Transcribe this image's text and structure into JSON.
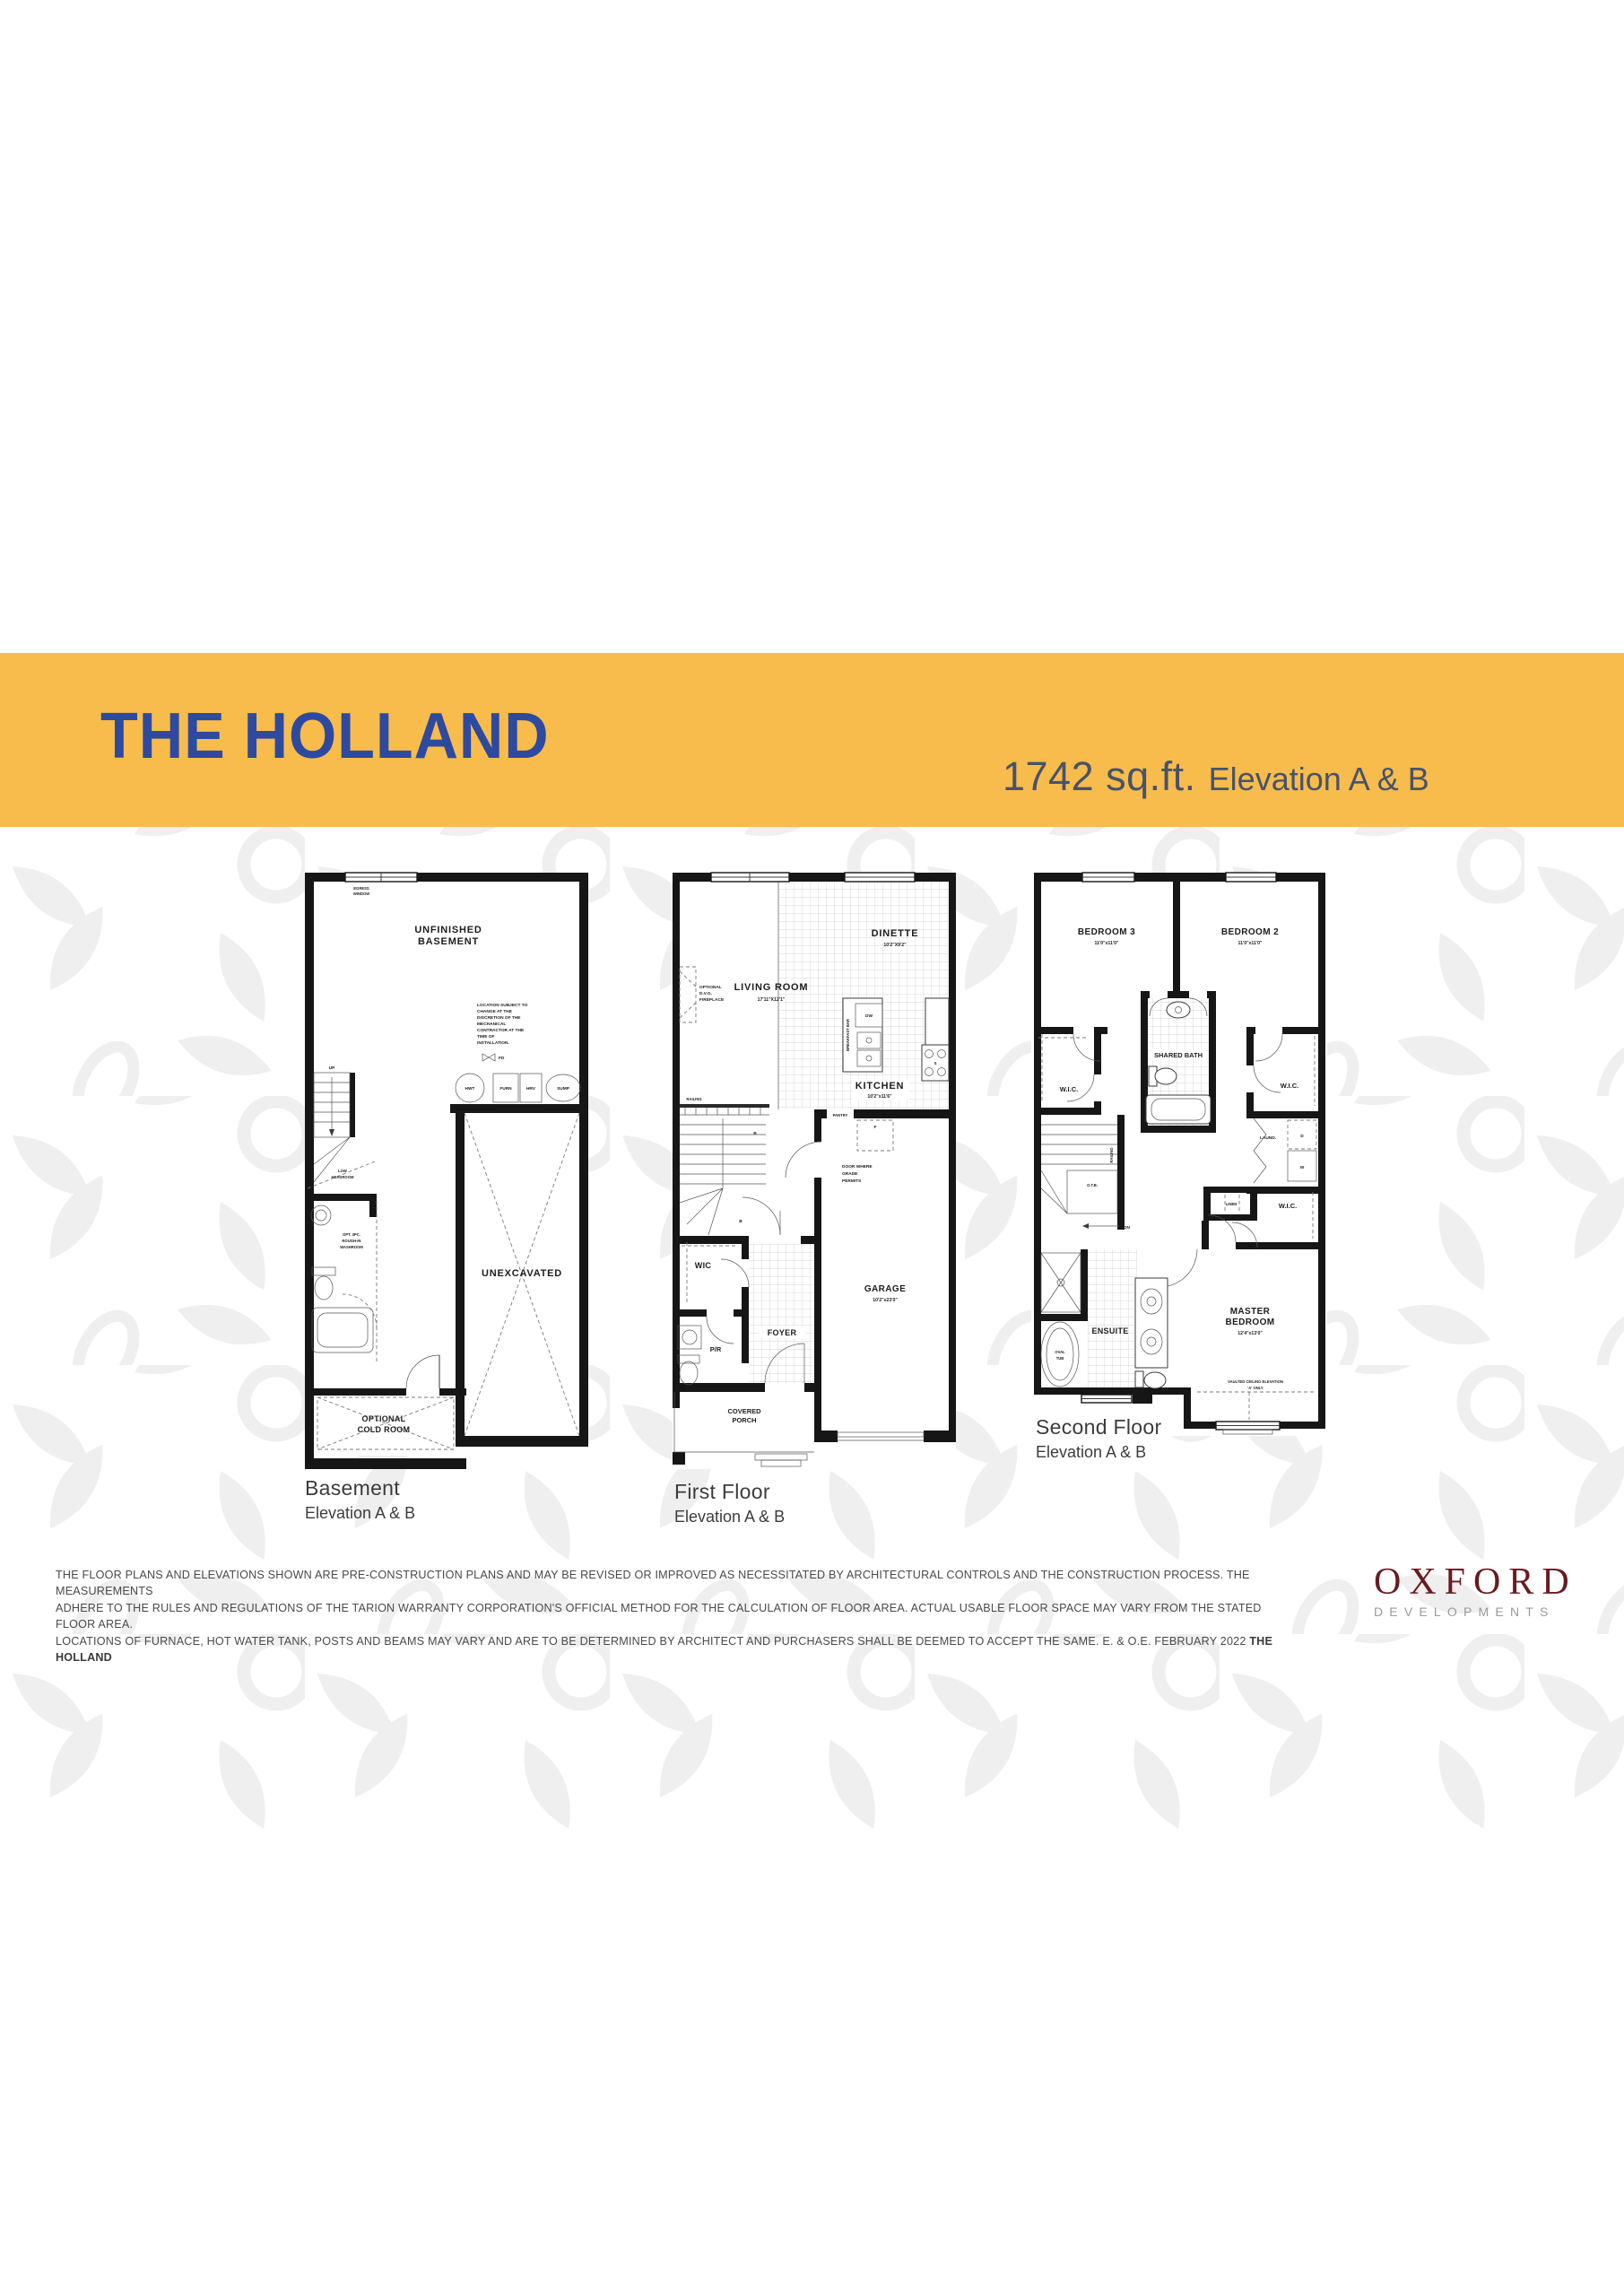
{
  "header": {
    "title": "THE HOLLAND",
    "sqft": "1742 sq.ft.",
    "elevation": "Elevation A & B"
  },
  "colors": {
    "band": "#F8BC4C",
    "title_blue": "#2E4AA0",
    "subtitle_slate": "#47536B",
    "wall_black": "#161616",
    "leaf_gray": "#EFEFEF",
    "caption_gray": "#3C3C3C",
    "disclaimer_gray": "#4A4A4A",
    "oxford_maroon": "#691A20",
    "developments_gray": "#9B9B9B"
  },
  "plans": {
    "basement": {
      "caption": "Basement",
      "caption_sub": "Elevation A & B",
      "egress_1": "EGRESS",
      "egress_2": "WINDOW",
      "room_1": "UNFINISHED",
      "room_2": "BASEMENT",
      "note": [
        "LOCATION SUBJECT TO",
        "CHANGE AT THE",
        "DISCRETION OF THE",
        "MECHANICAL",
        "CONTRACTOR AT THE",
        "TIME OF",
        "INSTALLATION."
      ],
      "fd": "FD",
      "up": "UP",
      "hwt": "HWT",
      "furn": "FURN",
      "hrv": "HRV",
      "sump": "SUMP",
      "low_1": "LOW",
      "low_2": "HEADROOM",
      "washroom": [
        "OPT. 3PC.",
        "ROUGH-IN",
        "WASHROOM"
      ],
      "unexcavated": "UNEXCAVATED",
      "cold_1": "OPTIONAL",
      "cold_2": "COLD ROOM"
    },
    "first": {
      "caption": "First Floor",
      "caption_sub": "Elevation A & B",
      "dinette": "DINETTE",
      "dinette_dims": "10'2\"X9'2\"",
      "living": "LIVING ROOM",
      "living_dims": "17'11\"X12'1\"",
      "fireplace": [
        "OPTIONAL",
        "D.V.G.",
        "FIREPLACE"
      ],
      "breakfast_bar": "BREAKFAST BAR",
      "dw": "DW",
      "kitchen": "KITCHEN",
      "kitchen_dims": "10'2\"x11'6\"",
      "pantry": "PANTRY",
      "fridge": "F",
      "stove": "S",
      "railing": "RAILING",
      "stair_b": "B",
      "door_note": [
        "DOOR WHERE",
        "GRADE",
        "PERMITS"
      ],
      "wic": "WIC",
      "pr": "P/R",
      "foyer": "FOYER",
      "porch_1": "COVERED",
      "porch_2": "PORCH",
      "garage": "GARAGE",
      "garage_dims": "10'2\"x23'0\""
    },
    "second": {
      "caption": "Second Floor",
      "caption_sub": "Elevation A & B",
      "bedroom3": "BEDROOM 3",
      "bedroom3_dims": "11'0\"x11'0\"",
      "bedroom2": "BEDROOM 2",
      "bedroom2_dims": "11'0\"x11'0\"",
      "shared_bath": "SHARED BATH",
      "wic_left": "W.I.C.",
      "wic_right": "W.I.C.",
      "wic_master": "W.I.C.",
      "laundry": "LAUND.",
      "dryer": "D",
      "washer": "W",
      "otb": "O.T.B.",
      "railing": "RAILING",
      "dn": "DN",
      "linen": "LINEN",
      "ensuite": "ENSUITE",
      "oval_1": "OVAL",
      "oval_2": "TUB",
      "master_1": "MASTER",
      "master_2": "BEDROOM",
      "master_dims": "12'4\"x13'0\"",
      "vaulted_1": "VAULTED CEILING ELEVATION",
      "vaulted_2": "'A' ONLY"
    }
  },
  "footer": {
    "disclaimer_1": "THE FLOOR PLANS AND ELEVATIONS SHOWN ARE PRE-CONSTRUCTION PLANS AND MAY BE REVISED OR IMPROVED AS NECESSITATED BY ARCHITECTURAL CONTROLS AND THE CONSTRUCTION PROCESS. THE MEASUREMENTS",
    "disclaimer_2": "ADHERE TO THE RULES AND REGULATIONS OF THE TARION WARRANTY CORPORATION'S OFFICIAL METHOD FOR THE CALCULATION OF FLOOR AREA. ACTUAL USABLE FLOOR SPACE MAY VARY FROM THE STATED FLOOR AREA.",
    "disclaimer_3": "LOCATIONS OF FURNACE, HOT WATER TANK, POSTS AND BEAMS MAY VARY AND ARE TO BE DETERMINED BY ARCHITECT AND PURCHASERS SHALL BE DEEMED TO ACCEPT THE SAME. E. & O.E.  FEBRUARY 2022 ",
    "plan_name_bold": "THE HOLLAND",
    "logo_name": "OXFORD",
    "logo_sub": "DEVELOPMENTS"
  }
}
